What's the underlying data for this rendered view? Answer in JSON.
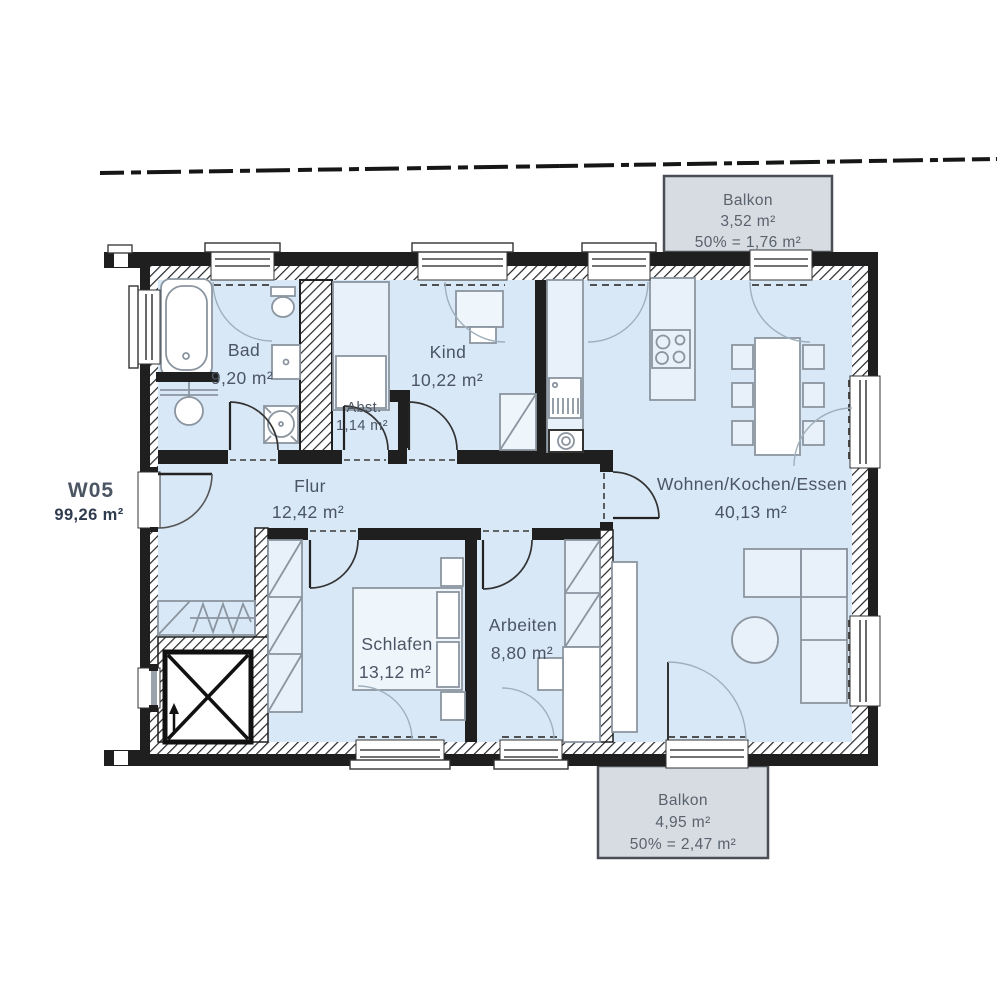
{
  "plan": {
    "unit": {
      "id": "W05",
      "area": "99,26 m²"
    },
    "rooms": {
      "bad": {
        "name": "Bad",
        "area": "9,20 m²"
      },
      "kind": {
        "name": "Kind",
        "area": "10,22 m²"
      },
      "abst": {
        "name": "Abst.",
        "area": "1,14 m²"
      },
      "flur": {
        "name": "Flur",
        "area": "12,42 m²"
      },
      "wohnen": {
        "name": "Wohnen/Kochen/Essen",
        "area": "40,13 m²"
      },
      "schlafen": {
        "name": "Schlafen",
        "area": "13,12 m²"
      },
      "arbeiten": {
        "name": "Arbeiten",
        "area": "8,80 m²"
      }
    },
    "balconies": {
      "top": {
        "name": "Balkon",
        "area": "3,52 m²",
        "counted": "50% = 1,76 m²"
      },
      "bottom": {
        "name": "Balkon",
        "area": "4,95 m²",
        "counted": "50% = 2,47 m²"
      }
    },
    "colors": {
      "unit_accent": "#a5c83e",
      "unit_area_text": "#2f3b4f",
      "room_fill": "#d9e8f6",
      "balcony_fill": "#d6dce2",
      "wall": "#1f1f1f",
      "label_text": "#4b5563"
    }
  }
}
